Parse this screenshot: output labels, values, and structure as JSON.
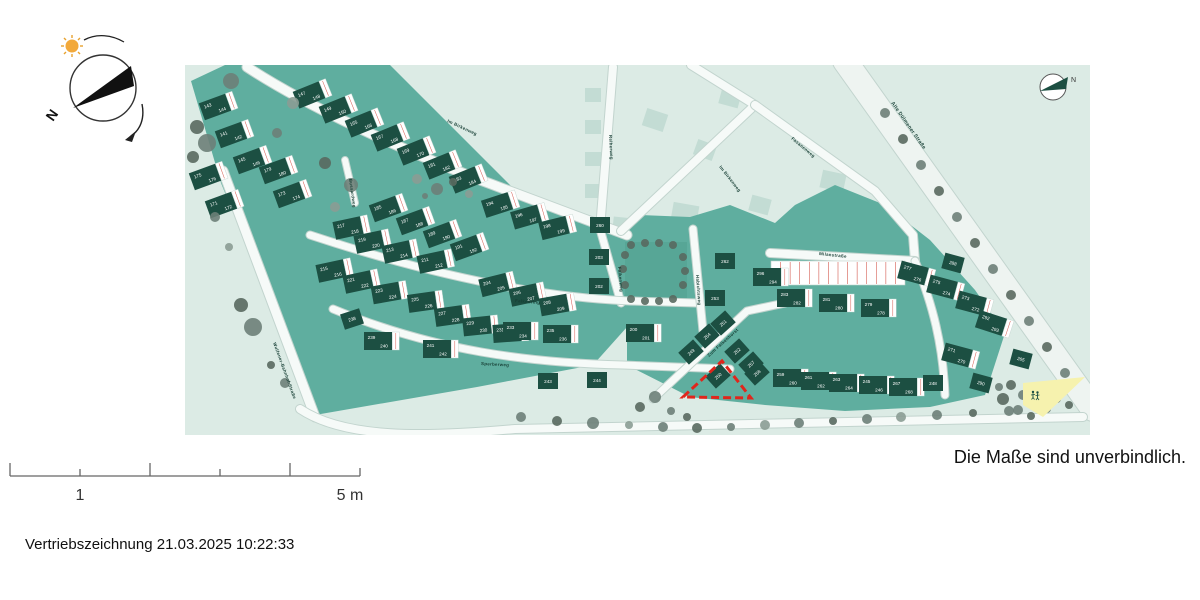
{
  "compass": {
    "north_label": "N"
  },
  "scalebar": {
    "label_1": "1",
    "label_5": "5 m"
  },
  "disclaimer": "Die Maße sind unverbindlich.",
  "footer": "Vertriebszeichnung 21.03.2025 10:22:33",
  "map": {
    "inner_compass_label": "N",
    "colors": {
      "bg": "#dcebe5",
      "parcel": "#5fae9f",
      "park": "#57a696",
      "future": "#c3dcd4",
      "house": "#1c4f42",
      "road": "#f6faf8",
      "road_major": "#eef4f1",
      "road_casing": "#c2d4ce",
      "label": "#173f35",
      "red_line": "#d4594f",
      "highlight": "#e0261c",
      "playground": "#f6f2ae"
    },
    "tree_shades": [
      "#6d7f78",
      "#59695f",
      "#8b9c93"
    ],
    "parcels": [
      "6,16 40,0 205,0 330,125 442,168 442,262 408,300 292,322 130,350 36,118",
      "442,168 455,150 505,152 545,140 590,158 610,140 650,120 700,140 745,175 790,225 820,268 800,330 745,342 660,346 580,340 505,332 442,300"
    ],
    "park": {
      "x": 440,
      "y": 177,
      "w": 62,
      "h": 58
    },
    "roads": [
      {
        "d": "M660,-4 L908,344",
        "w": 24,
        "big": 1
      },
      {
        "d": "M38,106 L130,352",
        "w": 9
      },
      {
        "d": "M115,344 C160,374 240,372 330,364 L898,352",
        "w": 8
      },
      {
        "d": "M62,2 C120,40 220,88 330,128 L442,170",
        "w": 9
      },
      {
        "d": "M506,0 L570,40 L436,166",
        "w": 8
      },
      {
        "d": "M570,40 L690,126 L728,170 L730,196",
        "w": 8
      },
      {
        "d": "M428,2 L415,164",
        "w": 8
      },
      {
        "d": "M415,164 L436,238",
        "w": 7
      },
      {
        "d": "M125,170 C240,208 350,232 445,236 L512,238",
        "w": 7
      },
      {
        "d": "M148,244 C250,286 345,298 438,300 L545,304",
        "w": 7
      },
      {
        "d": "M160,95 L170,138",
        "w": 6
      },
      {
        "d": "M508,164 L518,266",
        "w": 7
      },
      {
        "d": "M468,334 L562,246 L600,238",
        "w": 7
      },
      {
        "d": "M585,188 L730,196",
        "w": 8
      },
      {
        "d": "M730,196 C748,240 758,280 760,330",
        "w": 7
      }
    ],
    "parking": [
      {
        "x": 586,
        "y": 196,
        "w": 134,
        "h": 24,
        "n": 14
      }
    ],
    "future_buildings": [
      [
        408,
        30,
        16,
        14,
        0
      ],
      [
        408,
        62,
        16,
        14,
        0
      ],
      [
        408,
        94,
        16,
        14,
        0
      ],
      [
        408,
        126,
        16,
        14,
        0
      ],
      [
        470,
        55,
        22,
        18,
        18
      ],
      [
        520,
        85,
        20,
        16,
        20
      ],
      [
        545,
        33,
        20,
        16,
        15
      ],
      [
        575,
        140,
        20,
        16,
        15
      ],
      [
        500,
        148,
        26,
        18,
        10
      ],
      [
        448,
        160,
        40,
        13,
        6
      ],
      [
        668,
        152,
        30,
        22,
        0
      ],
      [
        648,
        116,
        24,
        18,
        12
      ]
    ],
    "streets": [
      {
        "t": "Wulfener-Bahnhof-Straße",
        "x": 88,
        "y": 278,
        "r": 70
      },
      {
        "t": "Im Birkenweg",
        "x": 262,
        "y": 57,
        "r": 25
      },
      {
        "t": "Im Birkenweg",
        "x": 534,
        "y": 102,
        "r": 52
      },
      {
        "t": "Reiherweg",
        "x": 424,
        "y": 70,
        "r": 87
      },
      {
        "t": "Fasanenweg",
        "x": 606,
        "y": 74,
        "r": 40
      },
      {
        "t": "Alte Dülmener Straße",
        "x": 706,
        "y": 38,
        "r": 55,
        "s": 5
      },
      {
        "t": "Milanstraße",
        "x": 634,
        "y": 190,
        "r": 6
      },
      {
        "t": "Falkenring",
        "x": 330,
        "y": 237,
        "r": 5
      },
      {
        "t": "Falkenweg",
        "x": 433,
        "y": 202,
        "r": 85
      },
      {
        "t": "Sperberweg",
        "x": 296,
        "y": 300,
        "r": 3
      },
      {
        "t": "Bussardweg",
        "x": 164,
        "y": 114,
        "r": 82
      },
      {
        "t": "Habichtsweg",
        "x": 511,
        "y": 210,
        "r": 86
      },
      {
        "t": "Zum Falkenhorst",
        "x": 524,
        "y": 292,
        "r": -42
      }
    ],
    "houses": [
      {
        "n": "143",
        "m": "144",
        "x": 30,
        "y": 42,
        "r": -20
      },
      {
        "n": "141",
        "m": "142",
        "x": 46,
        "y": 70,
        "r": -20
      },
      {
        "n": "145",
        "m": "146",
        "x": 64,
        "y": 96,
        "r": -20
      },
      {
        "n": "179",
        "m": "180",
        "x": 90,
        "y": 106,
        "r": -20
      },
      {
        "n": "175",
        "m": "176",
        "x": 20,
        "y": 112,
        "r": -20
      },
      {
        "n": "173",
        "m": "174",
        "x": 104,
        "y": 130,
        "r": -20
      },
      {
        "n": "171",
        "m": "172",
        "x": 36,
        "y": 140,
        "r": -20
      },
      {
        "n": "147",
        "m": "148",
        "x": 124,
        "y": 30,
        "r": -22
      },
      {
        "n": "149",
        "m": "150",
        "x": 150,
        "y": 45,
        "r": -22
      },
      {
        "n": "165",
        "m": "166",
        "x": 176,
        "y": 59,
        "r": -22
      },
      {
        "n": "167",
        "m": "168",
        "x": 202,
        "y": 73,
        "r": -22
      },
      {
        "n": "169",
        "m": "170",
        "x": 228,
        "y": 87,
        "r": -22
      },
      {
        "n": "181",
        "m": "182",
        "x": 254,
        "y": 101,
        "r": -22
      },
      {
        "n": "183",
        "m": "184",
        "x": 280,
        "y": 115,
        "r": -22
      },
      {
        "n": "185",
        "m": "186",
        "x": 200,
        "y": 144,
        "r": -20
      },
      {
        "n": "187",
        "m": "188",
        "x": 227,
        "y": 157,
        "r": -20
      },
      {
        "n": "189",
        "m": "190",
        "x": 254,
        "y": 170,
        "r": -20
      },
      {
        "n": "191",
        "m": "192",
        "x": 281,
        "y": 183,
        "r": -20
      },
      {
        "n": "217",
        "m": "218",
        "x": 163,
        "y": 163,
        "r": -12
      },
      {
        "n": "219",
        "m": "220",
        "x": 184,
        "y": 177,
        "r": -12
      },
      {
        "n": "213",
        "m": "214",
        "x": 212,
        "y": 187,
        "r": -12
      },
      {
        "n": "211",
        "m": "212",
        "x": 247,
        "y": 197,
        "r": -12
      },
      {
        "n": "215",
        "m": "216",
        "x": 146,
        "y": 206,
        "r": -12
      },
      {
        "n": "221",
        "m": "222",
        "x": 173,
        "y": 217,
        "r": -12
      },
      {
        "n": "223",
        "m": "224",
        "x": 201,
        "y": 228,
        "r": -10
      },
      {
        "n": "225",
        "m": "226",
        "x": 237,
        "y": 237,
        "r": -8
      },
      {
        "n": "227",
        "m": "228",
        "x": 264,
        "y": 251,
        "r": -8
      },
      {
        "n": "229",
        "m": "230",
        "x": 292,
        "y": 261,
        "r": -6
      },
      {
        "n": "231",
        "m": "232",
        "x": 322,
        "y": 268,
        "r": -4
      },
      {
        "n": "238",
        "x": 167,
        "y": 254,
        "r": -18
      },
      {
        "n": "239",
        "m": "240",
        "x": 193,
        "y": 276,
        "r": 0
      },
      {
        "n": "241",
        "m": "242",
        "x": 252,
        "y": 284,
        "r": 0
      },
      {
        "n": "243",
        "x": 363,
        "y": 316,
        "r": 0
      },
      {
        "n": "244",
        "x": 412,
        "y": 315,
        "r": 0
      },
      {
        "n": "194",
        "m": "195",
        "x": 312,
        "y": 140,
        "r": -18
      },
      {
        "n": "196",
        "m": "197",
        "x": 341,
        "y": 152,
        "r": -16
      },
      {
        "n": "198",
        "m": "199",
        "x": 369,
        "y": 163,
        "r": -14
      },
      {
        "n": "260",
        "x": 415,
        "y": 160,
        "r": 0
      },
      {
        "n": "203",
        "x": 414,
        "y": 192,
        "r": 0
      },
      {
        "n": "202",
        "x": 414,
        "y": 221,
        "r": 0
      },
      {
        "n": "204",
        "m": "205",
        "x": 309,
        "y": 220,
        "r": -14
      },
      {
        "n": "206",
        "m": "207",
        "x": 339,
        "y": 230,
        "r": -12
      },
      {
        "n": "208",
        "m": "209",
        "x": 369,
        "y": 240,
        "r": -10
      },
      {
        "n": "233",
        "m": "234",
        "x": 332,
        "y": 266,
        "r": 0
      },
      {
        "n": "235",
        "m": "236",
        "x": 372,
        "y": 269,
        "r": 0
      },
      {
        "n": "200",
        "m": "201",
        "x": 455,
        "y": 268,
        "r": 0
      },
      {
        "n": "262",
        "x": 540,
        "y": 196,
        "r": 0
      },
      {
        "n": "296",
        "m": "294",
        "x": 582,
        "y": 212,
        "r": 0
      },
      {
        "n": "253",
        "x": 530,
        "y": 233,
        "r": 0
      },
      {
        "n": "251",
        "x": 538,
        "y": 258,
        "r": -42
      },
      {
        "n": "254",
        "x": 522,
        "y": 271,
        "r": -42
      },
      {
        "n": "252",
        "x": 552,
        "y": 286,
        "r": -42
      },
      {
        "n": "257",
        "x": 566,
        "y": 299,
        "r": -42
      },
      {
        "n": "250",
        "x": 533,
        "y": 311,
        "r": -42
      },
      {
        "n": "249",
        "x": 506,
        "y": 287,
        "r": -42
      },
      {
        "n": "258",
        "x": 572,
        "y": 308,
        "r": -42
      },
      {
        "n": "283",
        "m": "282",
        "x": 606,
        "y": 233,
        "r": 0
      },
      {
        "n": "281",
        "m": "280",
        "x": 648,
        "y": 238,
        "r": 0
      },
      {
        "n": "279",
        "m": "278",
        "x": 690,
        "y": 243,
        "r": 0
      },
      {
        "n": "288",
        "x": 768,
        "y": 198,
        "r": 15
      },
      {
        "n": "277",
        "m": "276",
        "x": 728,
        "y": 208,
        "r": 15
      },
      {
        "n": "275",
        "m": "274",
        "x": 757,
        "y": 222,
        "r": 15
      },
      {
        "n": "273",
        "m": "272",
        "x": 786,
        "y": 238,
        "r": 15
      },
      {
        "n": "292",
        "m": "293",
        "x": 806,
        "y": 258,
        "r": 18
      },
      {
        "n": "271",
        "m": "270",
        "x": 772,
        "y": 290,
        "r": 15
      },
      {
        "n": "290",
        "x": 796,
        "y": 318,
        "r": 15
      },
      {
        "n": "265",
        "x": 836,
        "y": 294,
        "r": 15
      },
      {
        "n": "259",
        "m": "260",
        "x": 602,
        "y": 313,
        "r": 0
      },
      {
        "n": "261",
        "m": "262",
        "x": 630,
        "y": 316,
        "r": 0
      },
      {
        "n": "263",
        "m": "264",
        "x": 658,
        "y": 318,
        "r": 0
      },
      {
        "n": "245",
        "m": "246",
        "x": 688,
        "y": 320,
        "r": 0
      },
      {
        "n": "267",
        "m": "268",
        "x": 718,
        "y": 322,
        "r": 0
      },
      {
        "n": "248",
        "x": 748,
        "y": 318,
        "r": 0
      }
    ],
    "trees": [
      [
        12,
        62,
        7,
        1
      ],
      [
        22,
        78,
        9,
        0
      ],
      [
        8,
        92,
        6,
        1
      ],
      [
        46,
        16,
        8,
        0
      ],
      [
        108,
        38,
        6,
        2
      ],
      [
        92,
        68,
        5,
        0
      ],
      [
        140,
        98,
        6,
        1
      ],
      [
        166,
        120,
        7,
        0
      ],
      [
        150,
        142,
        5,
        2
      ],
      [
        30,
        152,
        5,
        0
      ],
      [
        56,
        240,
        7,
        1
      ],
      [
        68,
        262,
        9,
        0
      ],
      [
        44,
        182,
        4,
        2
      ],
      [
        100,
        318,
        5,
        0
      ],
      [
        86,
        300,
        4,
        1
      ],
      [
        232,
        114,
        5,
        2
      ],
      [
        252,
        124,
        6,
        0
      ],
      [
        268,
        117,
        4,
        1
      ],
      [
        284,
        129,
        4,
        2
      ],
      [
        240,
        131,
        3,
        0
      ],
      [
        446,
        180,
        4,
        1
      ],
      [
        460,
        178,
        4,
        1
      ],
      [
        474,
        178,
        4,
        1
      ],
      [
        488,
        180,
        4,
        1
      ],
      [
        498,
        192,
        4,
        1
      ],
      [
        500,
        206,
        4,
        1
      ],
      [
        498,
        220,
        4,
        1
      ],
      [
        488,
        234,
        4,
        1
      ],
      [
        474,
        236,
        4,
        1
      ],
      [
        460,
        236,
        4,
        1
      ],
      [
        446,
        234,
        4,
        1
      ],
      [
        440,
        220,
        4,
        1
      ],
      [
        438,
        204,
        4,
        1
      ],
      [
        440,
        190,
        4,
        1
      ],
      [
        336,
        352,
        5,
        0
      ],
      [
        372,
        356,
        5,
        1
      ],
      [
        408,
        358,
        6,
        0
      ],
      [
        444,
        360,
        4,
        2
      ],
      [
        478,
        362,
        5,
        0
      ],
      [
        512,
        363,
        5,
        1
      ],
      [
        546,
        362,
        4,
        0
      ],
      [
        580,
        360,
        5,
        2
      ],
      [
        614,
        358,
        5,
        0
      ],
      [
        648,
        356,
        4,
        1
      ],
      [
        682,
        354,
        5,
        0
      ],
      [
        716,
        352,
        5,
        2
      ],
      [
        752,
        350,
        5,
        0
      ],
      [
        788,
        348,
        4,
        1
      ],
      [
        824,
        346,
        5,
        0
      ],
      [
        858,
        344,
        4,
        1
      ],
      [
        700,
        48,
        5,
        0
      ],
      [
        718,
        74,
        5,
        1
      ],
      [
        736,
        100,
        5,
        0
      ],
      [
        754,
        126,
        5,
        1
      ],
      [
        772,
        152,
        5,
        0
      ],
      [
        790,
        178,
        5,
        1
      ],
      [
        808,
        204,
        5,
        0
      ],
      [
        826,
        230,
        5,
        1
      ],
      [
        844,
        256,
        5,
        0
      ],
      [
        862,
        282,
        5,
        1
      ],
      [
        880,
        308,
        5,
        0
      ],
      [
        826,
        320,
        5,
        1
      ],
      [
        838,
        330,
        5,
        0
      ],
      [
        850,
        338,
        5,
        1
      ],
      [
        862,
        344,
        4,
        0
      ],
      [
        818,
        334,
        6,
        1
      ],
      [
        833,
        345,
        5,
        0
      ],
      [
        846,
        351,
        4,
        1
      ],
      [
        814,
        322,
        4,
        0
      ],
      [
        860,
        326,
        4,
        1
      ],
      [
        872,
        334,
        4,
        0
      ],
      [
        884,
        340,
        4,
        1
      ],
      [
        470,
        332,
        6,
        0
      ],
      [
        455,
        342,
        5,
        1
      ],
      [
        486,
        346,
        4,
        0
      ],
      [
        502,
        352,
        4,
        1
      ]
    ],
    "playground": {
      "points": "838,318 900,312 858,352 838,340"
    },
    "highlight": {
      "points": "498,332 537,296 566,333"
    }
  }
}
